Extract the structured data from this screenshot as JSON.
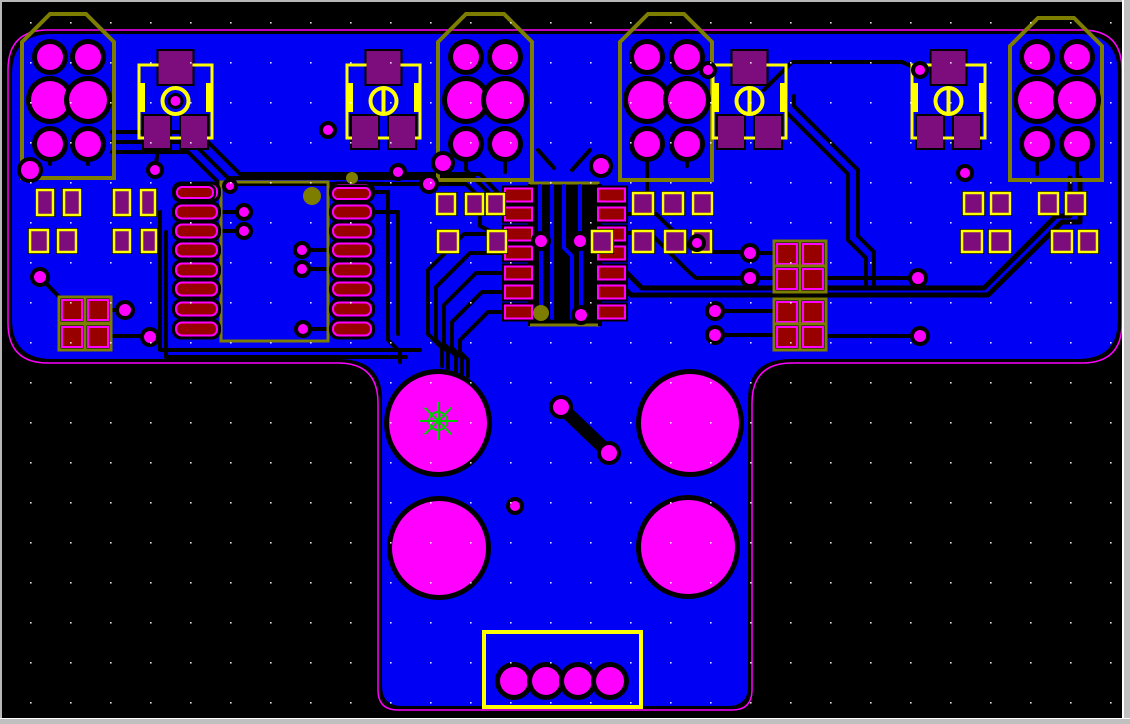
{
  "window": {
    "frame_side_color": "#c0c0c0",
    "frame_highlight": "#ffffff",
    "frame_top_color": "#b8b8b8",
    "right_border_w": 8,
    "bottom_border_w": 6,
    "top_border_w": 2,
    "left_border_w": 2
  },
  "colors": {
    "background": "#000000",
    "pour": "#0000f4",
    "board_outline": "#ff00ff",
    "silk_yellow": "#ffff00",
    "silk_olive": "#7d7d00",
    "pad_red": "#980000",
    "pad_purple": "#7d0d7d",
    "pad_magenta": "#ff00ff",
    "trace_black": "#000000",
    "blue_trace": "#0000f4",
    "grid_dot": "#ffffff",
    "marker_green": "#00cc00"
  },
  "grid": {
    "spacing": 40,
    "offset_x": 30,
    "offset_y": 22
  },
  "board": {
    "left": 8,
    "top": 30,
    "right": 1122,
    "wide_bottom": 363,
    "stem_left": 378,
    "stem_right": 752,
    "bottom": 710,
    "corner_radius": 40,
    "fillet_radius": 40,
    "stem_corner_radius": 20,
    "pour_inset": 4
  },
  "connectors": [
    {
      "x": 22,
      "y": 14,
      "w": 92,
      "h": 164,
      "chamfer": 28,
      "pad_cols": [
        50,
        88
      ],
      "pad_rows": [
        {
          "y": 57,
          "r": 13
        },
        {
          "y": 100,
          "r": 19
        },
        {
          "y": 144,
          "r": 13
        }
      ],
      "extra_pad": {
        "x": 30,
        "y": 170,
        "r": 9
      }
    },
    {
      "x": 438,
      "y": 14,
      "w": 94,
      "h": 166,
      "chamfer": 28,
      "pad_cols": [
        466,
        505
      ],
      "pad_rows": [
        {
          "y": 57,
          "r": 13
        },
        {
          "y": 100,
          "r": 19
        },
        {
          "y": 144,
          "r": 13
        }
      ],
      "extra_pad": {
        "x": 443,
        "y": 163,
        "r": 8
      }
    },
    {
      "x": 620,
      "y": 14,
      "w": 92,
      "h": 166,
      "chamfer": 28,
      "pad_cols": [
        647,
        687
      ],
      "pad_rows": [
        {
          "y": 57,
          "r": 13
        },
        {
          "y": 100,
          "r": 19
        },
        {
          "y": 144,
          "r": 13
        }
      ],
      "extra_pad": {
        "x": 601,
        "y": 166,
        "r": 8
      }
    },
    {
      "x": 1010,
      "y": 18,
      "w": 92,
      "h": 162,
      "chamfer": 28,
      "pad_cols": [
        1037,
        1077
      ],
      "pad_rows": [
        {
          "y": 57,
          "r": 13
        },
        {
          "y": 100,
          "r": 19
        },
        {
          "y": 144,
          "r": 13
        }
      ],
      "extra_pad": null
    }
  ],
  "caps": [
    {
      "x": 139,
      "y": 65,
      "w": 73,
      "h": 73,
      "bar": false
    },
    {
      "x": 347,
      "y": 65,
      "w": 73,
      "h": 73,
      "bar": true
    },
    {
      "x": 713,
      "y": 65,
      "w": 73,
      "h": 73,
      "bar": true
    },
    {
      "x": 912,
      "y": 65,
      "w": 73,
      "h": 73,
      "bar": true
    }
  ],
  "ic1": {
    "x": 221,
    "y": 182,
    "w": 107,
    "h": 159,
    "left_x": 176,
    "left_w": 41,
    "right_x": 333,
    "right_w": 38,
    "pad_h": 13,
    "pad_ys": [
      192,
      212,
      231,
      250,
      270,
      289,
      309,
      329
    ],
    "marker": [
      312,
      196,
      9
    ]
  },
  "ic2": {
    "x": 530,
    "y": 183,
    "w": 68,
    "h": 142,
    "cut_x": 528,
    "cut_y": 184,
    "cut_w": 74,
    "cut_h": 142,
    "left_x": 505,
    "right_x": 598,
    "pad_w": 27,
    "pad_h": 13,
    "pad_ys": [
      195,
      214,
      234,
      253,
      273,
      292,
      312
    ]
  },
  "purple_pads": [
    {
      "x": 437,
      "y": 194,
      "w": 18,
      "h": 20
    },
    {
      "x": 466,
      "y": 194,
      "w": 17,
      "h": 20
    },
    {
      "x": 487,
      "y": 194,
      "w": 17,
      "h": 20
    },
    {
      "x": 633,
      "y": 193,
      "w": 20,
      "h": 21
    },
    {
      "x": 663,
      "y": 193,
      "w": 20,
      "h": 21
    },
    {
      "x": 693,
      "y": 193,
      "w": 19,
      "h": 21
    },
    {
      "x": 438,
      "y": 231,
      "w": 20,
      "h": 21
    },
    {
      "x": 488,
      "y": 231,
      "w": 18,
      "h": 21
    },
    {
      "x": 592,
      "y": 231,
      "w": 20,
      "h": 21
    },
    {
      "x": 633,
      "y": 231,
      "w": 20,
      "h": 21
    },
    {
      "x": 665,
      "y": 231,
      "w": 20,
      "h": 21
    },
    {
      "x": 693,
      "y": 231,
      "w": 18,
      "h": 21
    },
    {
      "x": 37,
      "y": 190,
      "w": 16,
      "h": 25
    },
    {
      "x": 64,
      "y": 190,
      "w": 16,
      "h": 25
    },
    {
      "x": 114,
      "y": 190,
      "w": 16,
      "h": 25
    },
    {
      "x": 141,
      "y": 190,
      "w": 14,
      "h": 25
    },
    {
      "x": 30,
      "y": 230,
      "w": 18,
      "h": 22
    },
    {
      "x": 58,
      "y": 230,
      "w": 18,
      "h": 22
    },
    {
      "x": 114,
      "y": 230,
      "w": 16,
      "h": 22
    },
    {
      "x": 142,
      "y": 230,
      "w": 14,
      "h": 22
    },
    {
      "x": 964,
      "y": 193,
      "w": 19,
      "h": 21
    },
    {
      "x": 991,
      "y": 193,
      "w": 19,
      "h": 21
    },
    {
      "x": 1039,
      "y": 193,
      "w": 19,
      "h": 21
    },
    {
      "x": 1066,
      "y": 193,
      "w": 19,
      "h": 21
    },
    {
      "x": 962,
      "y": 231,
      "w": 20,
      "h": 21
    },
    {
      "x": 990,
      "y": 231,
      "w": 20,
      "h": 21
    },
    {
      "x": 1052,
      "y": 231,
      "w": 20,
      "h": 21
    },
    {
      "x": 1079,
      "y": 231,
      "w": 18,
      "h": 21
    }
  ],
  "red_quads": [
    {
      "x": 62,
      "y": 300,
      "size": 20,
      "dx": 26,
      "dy": 27
    },
    {
      "x": 777,
      "y": 244,
      "size": 20,
      "dx": 26,
      "dy": 25
    },
    {
      "x": 777,
      "y": 302,
      "size": 20,
      "dx": 26,
      "dy": 25
    }
  ],
  "pills": [
    {
      "x": 177,
      "y": 187,
      "w": 36,
      "h": 11
    },
    {
      "x": 333,
      "y": 188,
      "w": 37,
      "h": 11
    }
  ],
  "big_pads": [
    {
      "cx": 438,
      "cy": 423,
      "r": 49
    },
    {
      "cx": 690,
      "cy": 423,
      "r": 49
    },
    {
      "cx": 439,
      "cy": 548,
      "r": 47
    },
    {
      "cx": 688,
      "cy": 547,
      "r": 47
    }
  ],
  "jumper": {
    "x1": 561,
    "y1": 407,
    "x2": 609,
    "y2": 453,
    "pad_r": 8,
    "trace_w": 13
  },
  "bottom_connector": {
    "x": 484,
    "y": 632,
    "w": 157,
    "h": 75,
    "pads_y": 681,
    "pads_x": [
      514,
      546,
      578,
      610
    ],
    "pad_r": 14
  },
  "vias": [
    [
      155,
      170,
      5
    ],
    [
      230,
      186,
      4
    ],
    [
      244,
      212,
      5
    ],
    [
      244,
      231,
      5
    ],
    [
      302,
      250,
      5
    ],
    [
      302,
      269,
      5
    ],
    [
      303,
      329,
      5
    ],
    [
      328,
      130,
      5
    ],
    [
      398,
      172,
      5
    ],
    [
      429,
      184,
      6
    ],
    [
      541,
      241,
      6
    ],
    [
      580,
      241,
      6
    ],
    [
      581,
      315,
      6
    ],
    [
      697,
      243,
      5
    ],
    [
      708,
      70,
      5
    ],
    [
      920,
      70,
      5
    ],
    [
      750,
      253,
      6
    ],
    [
      750,
      278,
      6
    ],
    [
      715,
      311,
      6
    ],
    [
      715,
      335,
      6
    ],
    [
      918,
      278,
      6
    ],
    [
      920,
      336,
      6
    ],
    [
      965,
      173,
      5
    ],
    [
      515,
      506,
      5
    ],
    [
      40,
      277,
      6
    ],
    [
      125,
      310,
      6
    ],
    [
      150,
      337,
      6
    ]
  ],
  "olive_dots": [
    [
      312,
      196,
      9
    ],
    [
      352,
      178,
      6
    ],
    [
      541,
      313,
      8
    ]
  ],
  "origin_marker": {
    "x": 438,
    "y": 421,
    "circle_r": 9,
    "spoke": 19
  },
  "traces": [
    {
      "w": 4,
      "pts": [
        [
          112,
          132
        ],
        [
          198,
          132
        ],
        [
          240,
          174
        ],
        [
          480,
          174
        ],
        [
          500,
          195
        ]
      ]
    },
    {
      "w": 4,
      "pts": [
        [
          112,
          142
        ],
        [
          192,
          142
        ],
        [
          228,
          178
        ],
        [
          474,
          178
        ],
        [
          490,
          194
        ],
        [
          490,
          212
        ],
        [
          500,
          214
        ]
      ]
    },
    {
      "w": 4,
      "pts": [
        [
          112,
          152
        ],
        [
          188,
          152
        ],
        [
          220,
          184
        ],
        [
          466,
          184
        ],
        [
          480,
          198
        ],
        [
          480,
          226
        ],
        [
          494,
          233
        ],
        [
          500,
          233
        ]
      ]
    },
    {
      "w": 4,
      "pts": [
        [
          466,
          150
        ],
        [
          466,
          170
        ],
        [
          480,
          184
        ]
      ]
    },
    {
      "w": 4,
      "pts": [
        [
          505,
          150
        ],
        [
          505,
          172
        ]
      ]
    },
    {
      "w": 4,
      "pts": [
        [
          538,
          150
        ],
        [
          554,
          168
        ]
      ]
    },
    {
      "w": 4,
      "pts": [
        [
          590,
          150
        ],
        [
          572,
          170
        ]
      ]
    },
    {
      "w": 4,
      "pts": [
        [
          50,
          152
        ],
        [
          50,
          164
        ]
      ]
    },
    {
      "w": 4,
      "pts": [
        [
          88,
          152
        ],
        [
          88,
          164
        ]
      ]
    },
    {
      "w": 4,
      "pts": [
        [
          647,
          150
        ],
        [
          647,
          190
        ]
      ]
    },
    {
      "w": 4,
      "pts": [
        [
          687,
          150
        ],
        [
          687,
          166
        ]
      ]
    },
    {
      "w": 4,
      "pts": [
        [
          1037,
          152
        ],
        [
          1037,
          174
        ]
      ]
    },
    {
      "w": 4,
      "pts": [
        [
          1077,
          152
        ],
        [
          1077,
          178
        ]
      ]
    },
    {
      "w": 4,
      "pts": [
        [
          158,
          148
        ],
        [
          156,
          164
        ]
      ]
    },
    {
      "w": 4,
      "pts": [
        [
          505,
          234
        ],
        [
          464,
          234
        ],
        [
          428,
          270
        ],
        [
          428,
          334
        ],
        [
          442,
          348
        ],
        [
          442,
          366
        ]
      ]
    },
    {
      "w": 4,
      "pts": [
        [
          505,
          253
        ],
        [
          470,
          253
        ],
        [
          436,
          287
        ],
        [
          436,
          340
        ],
        [
          448,
          352
        ],
        [
          448,
          368
        ]
      ]
    },
    {
      "w": 4,
      "pts": [
        [
          505,
          273
        ],
        [
          476,
          273
        ],
        [
          444,
          305
        ],
        [
          444,
          344
        ],
        [
          456,
          356
        ],
        [
          456,
          372
        ]
      ]
    },
    {
      "w": 4,
      "pts": [
        [
          505,
          292
        ],
        [
          482,
          292
        ],
        [
          452,
          322
        ],
        [
          452,
          348
        ],
        [
          462,
          358
        ],
        [
          462,
          374
        ]
      ]
    },
    {
      "w": 4,
      "pts": [
        [
          505,
          312
        ],
        [
          488,
          312
        ],
        [
          460,
          340
        ],
        [
          460,
          352
        ],
        [
          468,
          360
        ],
        [
          468,
          376
        ]
      ]
    },
    {
      "w": 4,
      "pts": [
        [
          40,
          277
        ],
        [
          63,
          301
        ]
      ]
    },
    {
      "w": 4,
      "pts": [
        [
          110,
          310
        ],
        [
          122,
          310
        ]
      ]
    },
    {
      "w": 4,
      "pts": [
        [
          110,
          336
        ],
        [
          146,
          336
        ]
      ]
    },
    {
      "w": 4,
      "pts": [
        [
          160,
          212
        ],
        [
          160,
          350
        ],
        [
          420,
          350
        ]
      ]
    },
    {
      "w": 4,
      "pts": [
        [
          166,
          232
        ],
        [
          166,
          357
        ],
        [
          406,
          357
        ]
      ]
    },
    {
      "w": 4,
      "pts": [
        [
          219,
          212
        ],
        [
          239,
          212
        ]
      ]
    },
    {
      "w": 4,
      "pts": [
        [
          219,
          231
        ],
        [
          239,
          231
        ]
      ]
    },
    {
      "w": 4,
      "pts": [
        [
          307,
          250
        ],
        [
          331,
          250
        ]
      ]
    },
    {
      "w": 4,
      "pts": [
        [
          307,
          269
        ],
        [
          331,
          269
        ]
      ]
    },
    {
      "w": 4,
      "pts": [
        [
          308,
          329
        ],
        [
          331,
          329
        ]
      ]
    },
    {
      "w": 4,
      "pts": [
        [
          373,
          192
        ],
        [
          388,
          192
        ],
        [
          388,
          340
        ],
        [
          400,
          352
        ],
        [
          400,
          362
        ]
      ]
    },
    {
      "w": 4,
      "pts": [
        [
          373,
          212
        ],
        [
          398,
          212
        ],
        [
          398,
          334
        ]
      ]
    },
    {
      "w": 4,
      "pts": [
        [
          625,
          214
        ],
        [
          656,
          214
        ],
        [
          695,
          252
        ],
        [
          744,
          252
        ]
      ]
    },
    {
      "w": 4,
      "pts": [
        [
          625,
          233
        ],
        [
          650,
          233
        ],
        [
          688,
          271
        ],
        [
          696,
          278
        ],
        [
          744,
          278
        ]
      ]
    },
    {
      "w": 5,
      "pts": [
        [
          626,
          272
        ],
        [
          642,
          288
        ],
        [
          984,
          288
        ],
        [
          1056,
          216
        ],
        [
          1070,
          216
        ],
        [
          1070,
          178
        ]
      ]
    },
    {
      "w": 5,
      "pts": [
        [
          626,
          290
        ],
        [
          631,
          295
        ],
        [
          988,
          295
        ],
        [
          1062,
          222
        ],
        [
          1080,
          222
        ],
        [
          1080,
          178
        ]
      ]
    },
    {
      "w": 4,
      "pts": [
        [
          756,
          253
        ],
        [
          779,
          253
        ]
      ]
    },
    {
      "w": 4,
      "pts": [
        [
          756,
          278
        ],
        [
          779,
          278
        ]
      ]
    },
    {
      "w": 4,
      "pts": [
        [
          823,
          278
        ],
        [
          918,
          278
        ]
      ]
    },
    {
      "w": 4,
      "pts": [
        [
          721,
          311
        ],
        [
          779,
          311
        ]
      ]
    },
    {
      "w": 4,
      "pts": [
        [
          721,
          335
        ],
        [
          779,
          335
        ]
      ]
    },
    {
      "w": 4,
      "pts": [
        [
          823,
          336
        ],
        [
          920,
          336
        ]
      ]
    },
    {
      "w": 4,
      "pts": [
        [
          786,
          100
        ],
        [
          786,
          112
        ],
        [
          848,
          174
        ],
        [
          848,
          240
        ],
        [
          866,
          258
        ],
        [
          866,
          286
        ]
      ]
    },
    {
      "w": 4,
      "pts": [
        [
          794,
          96
        ],
        [
          794,
          106
        ],
        [
          858,
          170
        ],
        [
          858,
          236
        ],
        [
          874,
          252
        ],
        [
          874,
          286
        ]
      ]
    },
    {
      "w": 4,
      "pts": [
        [
          764,
          90
        ],
        [
          792,
          62
        ],
        [
          902,
          62
        ],
        [
          920,
          70
        ]
      ]
    }
  ],
  "blue_traces": [
    {
      "w": 4,
      "pts": [
        [
          540,
          186
        ],
        [
          540,
          234
        ]
      ]
    },
    {
      "w": 4,
      "pts": [
        [
          541,
          248
        ],
        [
          541,
          316
        ]
      ]
    },
    {
      "w": 4,
      "pts": [
        [
          552,
          186
        ],
        [
          552,
          318
        ]
      ]
    },
    {
      "w": 4,
      "pts": [
        [
          564,
          186
        ],
        [
          564,
          248
        ],
        [
          572,
          256
        ],
        [
          572,
          318
        ]
      ]
    },
    {
      "w": 4,
      "pts": [
        [
          580,
          186
        ],
        [
          580,
          234
        ]
      ]
    },
    {
      "w": 4,
      "pts": [
        [
          581,
          248
        ],
        [
          581,
          308
        ]
      ]
    }
  ]
}
